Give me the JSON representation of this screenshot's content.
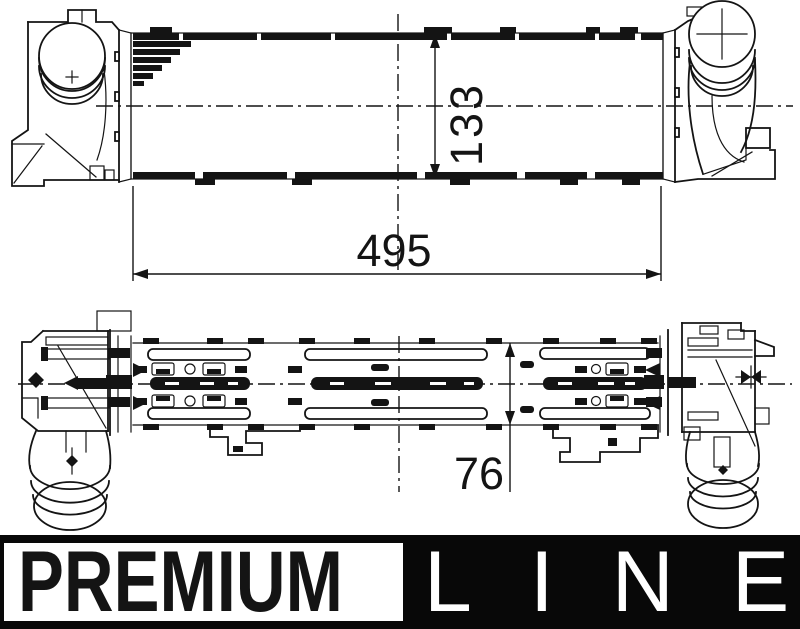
{
  "colors": {
    "ink": "#141414",
    "paper": "#ffffff",
    "banner_bg": "#080808",
    "banner_box": "#ffffff"
  },
  "drawing": {
    "dimensions": {
      "core_height": "133",
      "core_length": "495",
      "core_depth": "76"
    }
  },
  "branding": {
    "premium": "PREMIUM",
    "line": "LINE"
  }
}
